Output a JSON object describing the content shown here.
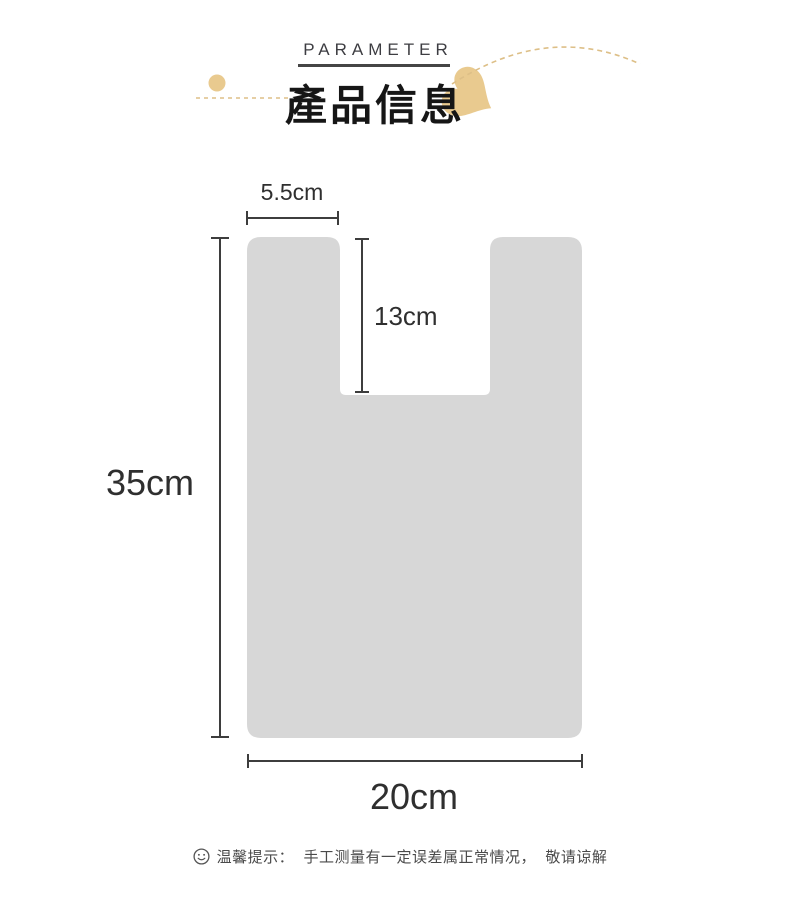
{
  "header": {
    "eyebrow": "PARAMETER",
    "title": "產品信息"
  },
  "diagram": {
    "handle_width_label": "5.5cm",
    "handle_depth_label": "13cm",
    "bag_height_label": "35cm",
    "bag_width_label": "20cm"
  },
  "footer": {
    "note": "温馨提示：  手工测量有一定误差属正常情况，  敬请谅解"
  },
  "icons": {
    "heart": "heart-accent-icon",
    "dot": "gold-dot-accent",
    "smiley": "smiley-face-icon"
  },
  "colors": {
    "accent_gold": "#e9ca8f",
    "accent_gold_dash": "#ddbf87",
    "bag_fill": "#d7d7d7",
    "dimension_line": "#3d3d3d",
    "title_text": "#161616",
    "note_text": "#4a4a4a"
  }
}
